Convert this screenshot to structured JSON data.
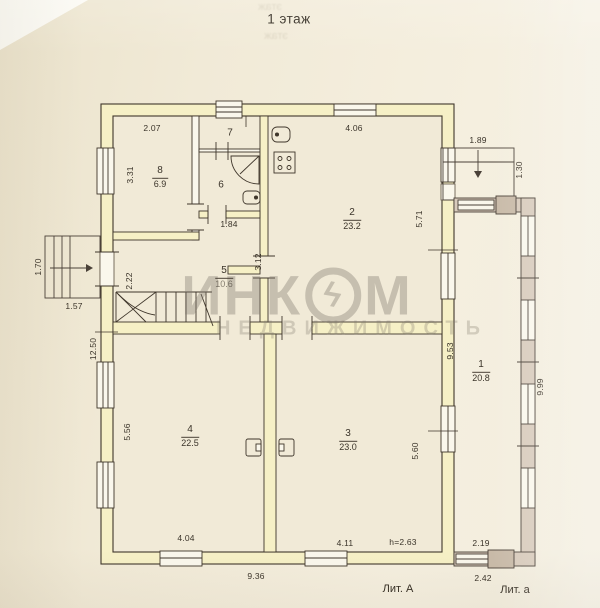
{
  "title": "1 этаж",
  "ghost_text": "этаж",
  "watermark": {
    "name_pre": "ИНК",
    "bolt_glyph": "ϟ",
    "name_post": "М",
    "subtitle": "НЕДВИЖИМОСТЬ"
  },
  "rooms": {
    "r1": {
      "num": "1",
      "area": "20.8"
    },
    "r2": {
      "num": "2",
      "area": "23.2"
    },
    "r3": {
      "num": "3",
      "area": "23.0"
    },
    "r4": {
      "num": "4",
      "area": "22.5"
    },
    "r5": {
      "num": "5",
      "area": "10.6"
    },
    "r6": {
      "num": "6"
    },
    "r7": {
      "num": "7"
    },
    "r8": {
      "num": "8",
      "area": "6.9"
    }
  },
  "dims": {
    "room8_top": "2.07",
    "room8_left": "3.31",
    "room2_top": "4.06",
    "room2_right": "5.71",
    "porch_top": "1.89",
    "porch_right": "1.30",
    "hall_pass": "1.84",
    "hall_left": "2.22",
    "hall_right": "3.12",
    "stoop_left": "1.70",
    "stoop_bottom": "1.57",
    "left_total": "12.50",
    "room4_left": "5.56",
    "room4_bottom": "4.04",
    "room3_bottom": "4.11",
    "room3_right": "5.60",
    "veranda_left": "9.53",
    "veranda_right": "9.99",
    "veranda_width": "2.19",
    "veranda_bottom": "2.42",
    "bottom_total": "9.36",
    "ceiling_height": "h=2.63"
  },
  "litera": {
    "main": "Лит. А",
    "annex": "Лит. а"
  },
  "colors": {
    "paper": "#f1ead7",
    "line": "#3f362b",
    "wall_fill": "#f6f0c6",
    "annex_wall": "#d8cbbc",
    "annex_post": "#c9bba9",
    "watermark_gray": "#807a6e"
  }
}
